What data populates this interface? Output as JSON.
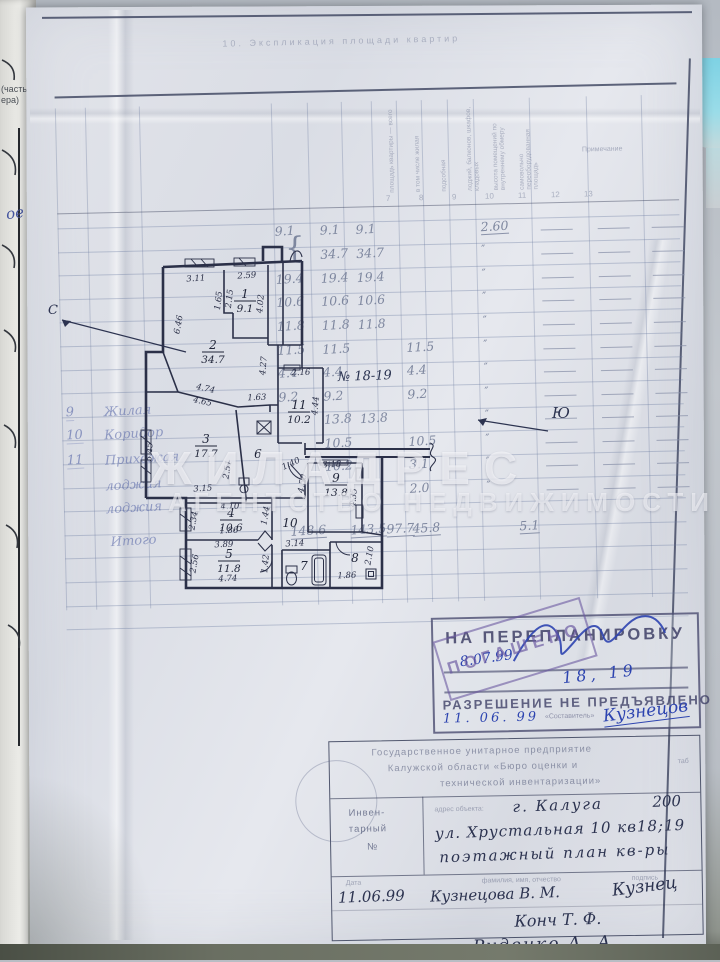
{
  "sheet": {
    "caption": "10. Экспликация площади квартир",
    "column_numbers": [
      "7",
      "8",
      "9",
      "10",
      "11",
      "12",
      "13"
    ],
    "rotated_headers": [
      "площадь квартиры — всего",
      "в том числе жилая",
      "подсобная",
      "лоджий, балконов, шкафов, кладовых",
      "высота помещений по внутреннему обмеру",
      "самовольно переоборудованная площадь"
    ],
    "remark_header": "Примечание"
  },
  "margin": {
    "fragment1": "(часть,",
    "fragment2": "ера)",
    "handwriting": "ое"
  },
  "compass": {
    "north": "С",
    "south": "Ю"
  },
  "apartment_note": "№ 18-19",
  "row_labels": [
    {
      "num": "9",
      "name": "Жилая"
    },
    {
      "num": "10",
      "name": "Коридор"
    },
    {
      "num": "11",
      "name": "Прихожая"
    },
    {
      "num": "",
      "name": "лоджия"
    },
    {
      "num": "",
      "name": "лоджия"
    },
    {
      "num": "",
      "name": "Итого"
    }
  ],
  "table_rows": [
    {
      "y": 228,
      "cells": {
        "a": "9.1",
        "b": "9.1",
        "c": "9.1",
        "h": "2.60"
      }
    },
    {
      "y": 252,
      "cells": {
        "b": "34.7",
        "c": "34.7",
        "h": "″"
      }
    },
    {
      "y": 276,
      "cells": {
        "a": "19.4",
        "b": "19.4",
        "c": "19.4",
        "h": "″"
      }
    },
    {
      "y": 299,
      "cells": {
        "a": "10.6",
        "b": "10.6",
        "c": "10.6",
        "h": "″"
      }
    },
    {
      "y": 323,
      "cells": {
        "a": "11.8",
        "b": "11.8",
        "c": "11.8",
        "h": "″"
      }
    },
    {
      "y": 347,
      "cells": {
        "a": "11.5",
        "b": "11.5",
        "d": "11.5",
        "h": "″"
      }
    },
    {
      "y": 370,
      "cells": {
        "a": "4.4",
        "b": "4.4",
        "d": "4.4",
        "h": "″"
      }
    },
    {
      "y": 394,
      "cells": {
        "a": "9.2",
        "b": "9.2",
        "d": "9.2",
        "h": "″"
      }
    },
    {
      "y": 417,
      "cells": {
        "b": "13.8",
        "c": "13.8",
        "h": "″"
      }
    },
    {
      "y": 441,
      "cells": {
        "b": "10.5",
        "d": "10.5",
        "h": "″"
      }
    },
    {
      "y": 464,
      "cells": {
        "b": "10.2",
        "d": "3.1",
        "h": "″"
      }
    },
    {
      "y": 488,
      "cells": {
        "d": "2.0",
        "h": "″"
      }
    }
  ],
  "totals": [
    {
      "x": 292,
      "v": "148.6"
    },
    {
      "x": 352,
      "v": "143.5"
    },
    {
      "x": 388,
      "v": "97.7"
    },
    {
      "x": 414,
      "v": "45.8"
    },
    {
      "x": 521,
      "v": "5.1"
    }
  ],
  "plan": {
    "rooms": [
      {
        "num": "1",
        "area": "9.1",
        "x": 245,
        "y": 298
      },
      {
        "num": "2",
        "area": "34.7",
        "x": 213,
        "y": 349
      },
      {
        "num": "3",
        "area": "17.7",
        "x": 206,
        "y": 443
      },
      {
        "num": "4",
        "area": "10.6",
        "x": 231,
        "y": 517
      },
      {
        "num": "5",
        "area": "11.8",
        "x": 229,
        "y": 558
      },
      {
        "num": "6",
        "area": "",
        "x": 258,
        "y": 458
      },
      {
        "num": "7",
        "area": "",
        "x": 304,
        "y": 570
      },
      {
        "num": "8",
        "area": "",
        "x": 355,
        "y": 562
      },
      {
        "num": "9",
        "area": "13.8",
        "x": 336,
        "y": 482
      },
      {
        "num": "10",
        "area": "",
        "x": 290,
        "y": 527
      },
      {
        "num": "11",
        "area": "10.2",
        "x": 299,
        "y": 409
      }
    ],
    "dims": [
      {
        "t": "3.11",
        "x": 196,
        "y": 281,
        "r": -4
      },
      {
        "t": "2.59",
        "x": 247,
        "y": 278,
        "r": -4
      },
      {
        "t": "1.65",
        "x": 221,
        "y": 301,
        "r": -83
      },
      {
        "t": "2.15",
        "x": 232,
        "y": 299,
        "r": -83
      },
      {
        "t": "4.02",
        "x": 263,
        "y": 304,
        "r": -85
      },
      {
        "t": "6.46",
        "x": 181,
        "y": 325,
        "r": -80
      },
      {
        "t": "4.27",
        "x": 266,
        "y": 366,
        "r": -85
      },
      {
        "t": "4.74",
        "x": 205,
        "y": 391,
        "r": 12
      },
      {
        "t": "4.65",
        "x": 202,
        "y": 404,
        "r": 12
      },
      {
        "t": "1.63",
        "x": 257,
        "y": 400,
        "r": -2
      },
      {
        "t": "5.45",
        "x": 152,
        "y": 452,
        "r": -86
      },
      {
        "t": "3.15",
        "x": 203,
        "y": 491,
        "r": -4
      },
      {
        "t": "2.51",
        "x": 230,
        "y": 470,
        "r": -80
      },
      {
        "t": "2.16",
        "x": 301,
        "y": 375,
        "r": -2
      },
      {
        "t": "4.44",
        "x": 318,
        "y": 406,
        "r": -85
      },
      {
        "t": "1.40",
        "x": 292,
        "y": 466,
        "r": -25
      },
      {
        "t": "4.50",
        "x": 305,
        "y": 484,
        "r": -80
      },
      {
        "t": "3.18",
        "x": 332,
        "y": 467,
        "r": -3
      },
      {
        "t": "4.35",
        "x": 356,
        "y": 498,
        "r": -85
      },
      {
        "t": "4.10",
        "x": 230,
        "y": 509,
        "r": -2
      },
      {
        "t": "2.34",
        "x": 196,
        "y": 521,
        "r": -80
      },
      {
        "t": "1.86",
        "x": 229,
        "y": 533,
        "r": -2
      },
      {
        "t": "1.44",
        "x": 268,
        "y": 516,
        "r": -80
      },
      {
        "t": "3.89",
        "x": 224,
        "y": 547,
        "r": -2
      },
      {
        "t": "2.56",
        "x": 197,
        "y": 564,
        "r": -80
      },
      {
        "t": "4.74",
        "x": 228,
        "y": 581,
        "r": -2
      },
      {
        "t": "1.42",
        "x": 268,
        "y": 564,
        "r": -85
      },
      {
        "t": "3.14",
        "x": 295,
        "y": 546,
        "r": -3
      },
      {
        "t": "1.86",
        "x": 347,
        "y": 578,
        "r": -2
      },
      {
        "t": "2.10",
        "x": 372,
        "y": 556,
        "r": -80
      }
    ]
  },
  "watermark": {
    "line1": "ЖИЛАДРЕС",
    "line2": "АГЕНТСТВО НЕДВИЖИМОСТИ"
  },
  "stamp": {
    "line1": "НА ПЕРЕПЛАНИРОВКУ",
    "date1": "8.07.99",
    "apartments": "18, 19",
    "line2": "РАЗРЕШЕНИЕ НЕ ПРЕДЪЯВЛЕНО",
    "small": "«Составитель»",
    "date2": "11. 06. 99",
    "signature": "Кузнецов",
    "overlay": "ПОГАШЕНО"
  },
  "title_block": {
    "org1": "Государственное унитарное предприятие",
    "org2": "Калужской области «Бюро оценки и",
    "org3": "технической инвентаризации»",
    "tab": "таб",
    "inv1": "Инвен-",
    "inv2": "тарный",
    "inv3": "№",
    "addr_hint": "адрес объекта:",
    "city": "г. Калуга",
    "number": "200",
    "address": "ул. Хрустальная 10 кв18;19",
    "doc_type": "поэтажный план кв-ры",
    "date_label": "Дата",
    "col_hint1": "фамилия, имя, отчество",
    "col_hint2": "подпись",
    "date": "11.06.99",
    "executor": "Кузнецова В. М.",
    "sig1": "Кузнец",
    "name2": "Конч Т. Ф.",
    "name3": "Руденко А. А."
  }
}
